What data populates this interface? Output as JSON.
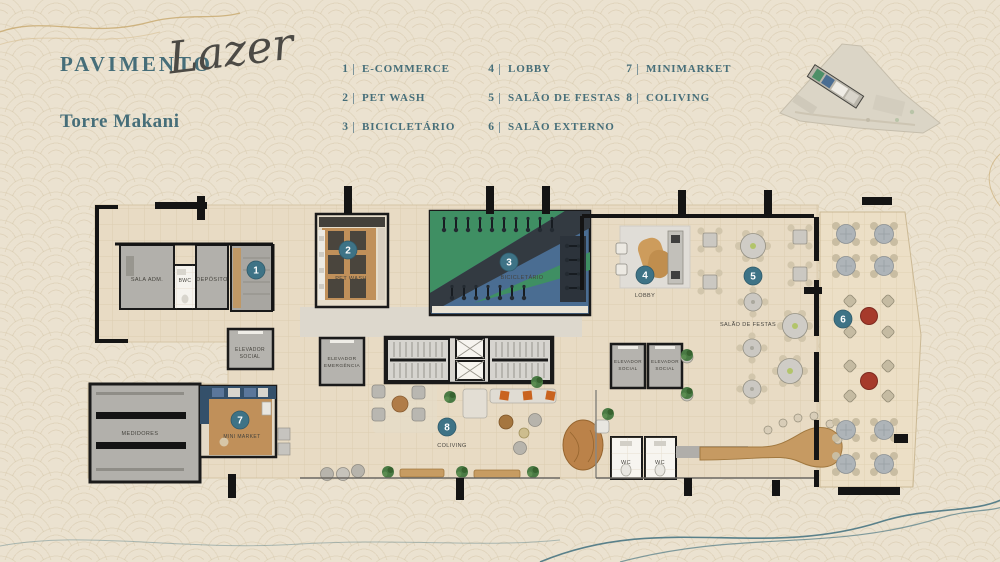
{
  "header": {
    "title_prefix": "PAVIMENTO",
    "title_script": "Lazer",
    "subtitle": "Torre Makani"
  },
  "legend": {
    "items": [
      {
        "num": "1",
        "label": "E-COMMERCE"
      },
      {
        "num": "2",
        "label": "PET WASH"
      },
      {
        "num": "3",
        "label": "BICICLETÁRIO"
      },
      {
        "num": "4",
        "label": "LOBBY"
      },
      {
        "num": "5",
        "label": "SALÃO DE FESTAS"
      },
      {
        "num": "6",
        "label": "SALÃO EXTERNO"
      },
      {
        "num": "7",
        "label": "MINIMARKET"
      },
      {
        "num": "8",
        "label": "COLIVING"
      }
    ]
  },
  "plan": {
    "rooms": {
      "sala_adm": "SALA ADM.",
      "bwc": "BWC",
      "deposito": "DEPÓSITO",
      "elevador": "ELEVADOR",
      "social": "SOCIAL",
      "emergencia": "EMERGÊNCIA",
      "pet_wash": "PET WASH",
      "bicicletario": "BICICLETÁRIO",
      "lobby": "LOBBY",
      "salao_de_festas": "SALÃO DE FESTAS",
      "medidores": "MEDIDORES",
      "mini_market": "MINI MARKET",
      "coliving": "COLIVING",
      "wc": "WC"
    },
    "markers": [
      {
        "num": "1"
      },
      {
        "num": "2"
      },
      {
        "num": "3"
      },
      {
        "num": "4"
      },
      {
        "num": "5"
      },
      {
        "num": "6"
      },
      {
        "num": "7"
      },
      {
        "num": "8"
      }
    ]
  },
  "colors": {
    "accent_teal": "#3e7386",
    "text_teal": "#466e79",
    "red_accent": "#a63a2b",
    "green_area": "#3f8f63",
    "blue_area": "#4a6d92",
    "background": "#ebe2d0"
  }
}
